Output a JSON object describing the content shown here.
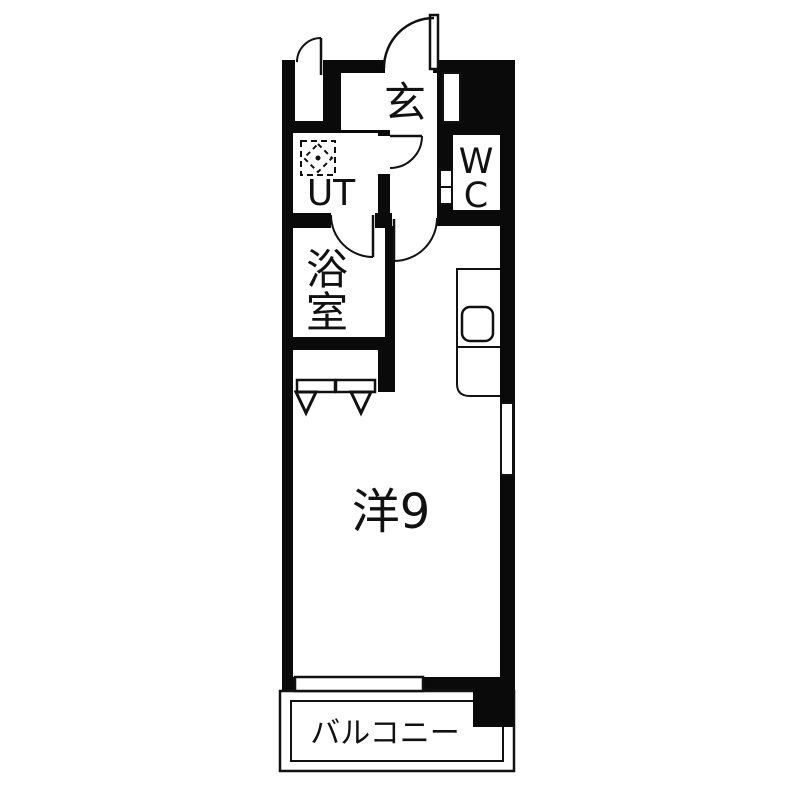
{
  "plan": {
    "title": "apartment-floorplan",
    "colors": {
      "wall": "#0a0a0a",
      "floor": "#ffffff",
      "background": "#ffffff",
      "line": "#111111"
    },
    "rooms": {
      "entrance": {
        "label": "玄"
      },
      "utility": {
        "label": "UT"
      },
      "wc": {
        "label_chars": [
          "W",
          "C"
        ]
      },
      "bath": {
        "label_chars": [
          "浴",
          "室"
        ]
      },
      "main": {
        "label": "洋9"
      },
      "balcony": {
        "label": "バルコニー"
      }
    },
    "icons": [
      "washing-machine-icon",
      "kitchen-sink-icon",
      "door-swing-icon",
      "folding-door-icon",
      "window-icon"
    ]
  }
}
